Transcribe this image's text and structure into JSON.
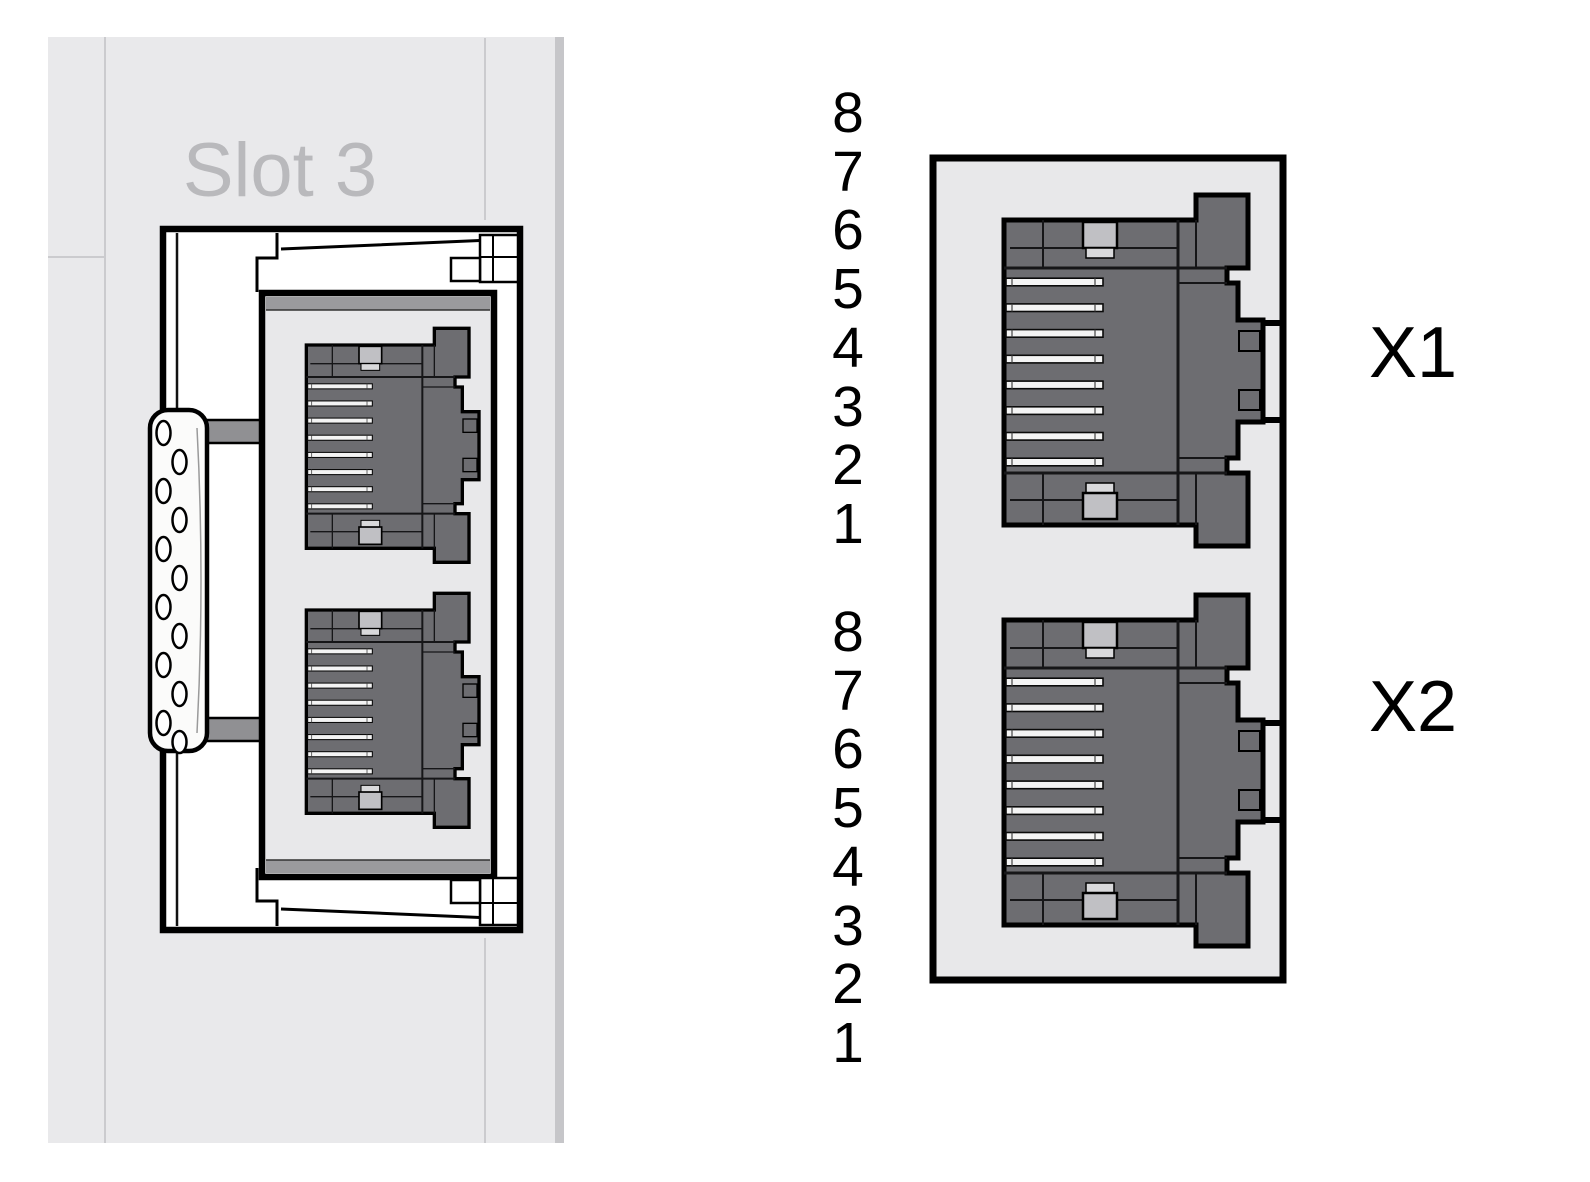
{
  "diagram": {
    "left_module": {
      "slot_label": "Slot 3"
    },
    "port_detail": {
      "ports": [
        {
          "label": "X1",
          "pin_numbers": [
            "8",
            "7",
            "6",
            "5",
            "4",
            "3",
            "2",
            "1"
          ]
        },
        {
          "label": "X2",
          "pin_numbers": [
            "8",
            "7",
            "6",
            "5",
            "4",
            "3",
            "2",
            "1"
          ]
        }
      ]
    }
  },
  "colors": {
    "panel": "#e9e9eb",
    "panel_edge": "#c6c6c9",
    "seam": "#cbcbce",
    "label_gray": "#b9b9bc",
    "module_fill": "#ffffff",
    "outline": "#000000",
    "inner_panel": "#e8e8ea",
    "frame_bar": "#9a9a9d",
    "bar_gray": "#909093",
    "jack": "#6d6d71",
    "clip": "#c0c0c4",
    "clip_light": "#d9d9db",
    "pin_fill": "#f4f4f4",
    "strip": "#fbfbfa"
  }
}
